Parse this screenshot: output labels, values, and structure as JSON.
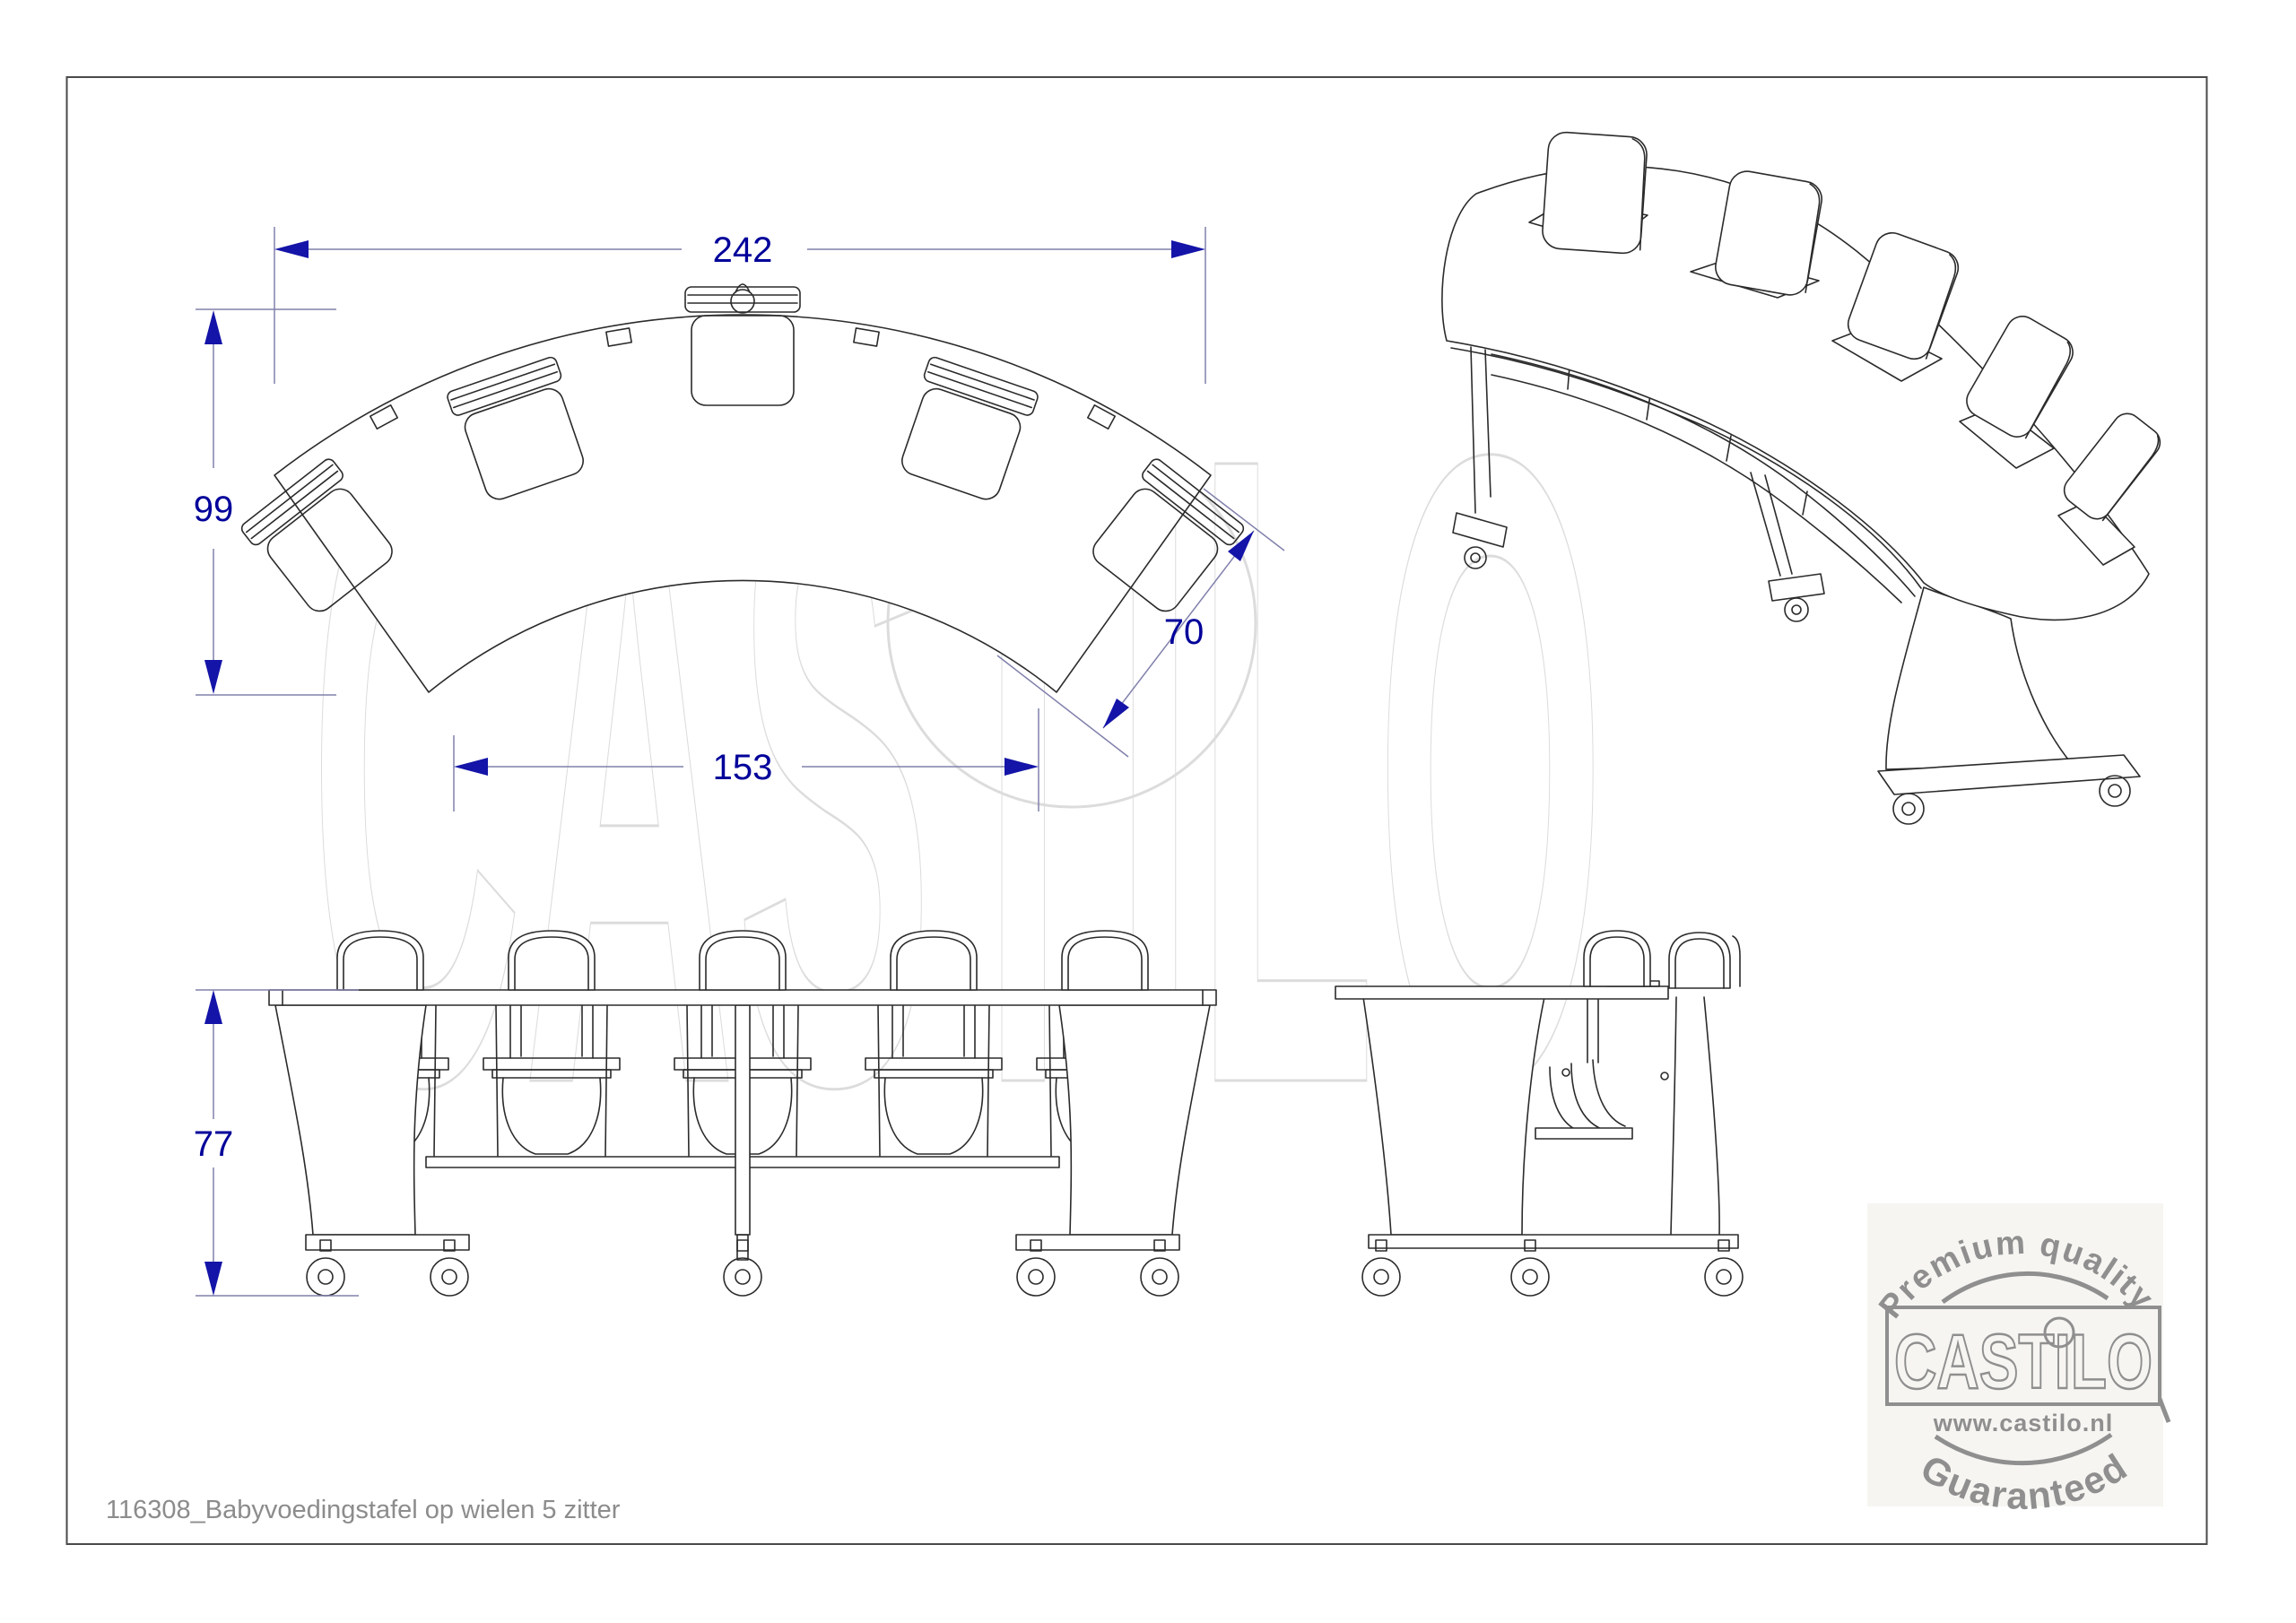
{
  "document": {
    "caption": "116308_Babyvoedingstafel op wielen 5 zitter"
  },
  "watermark": {
    "text": "CASTILO"
  },
  "dimensions": {
    "overall_width": "242",
    "overall_depth": "99",
    "inner_width": "153",
    "top_depth": "70",
    "height": "77"
  },
  "stamp": {
    "top_arc": "Premium quality",
    "brand": "CASTILO",
    "website": "www.castilo.nl",
    "bottom_arc": "Guaranteed"
  },
  "colors": {
    "dimension_text": "#00009a",
    "dimension_line": "#8080ac",
    "dimension_arrow": "#1414a8",
    "drawing_line": "#2b2b2b",
    "watermark": "#dcdcdc",
    "stamp": "#8f8f8f",
    "caption": "#8c8c8c"
  }
}
